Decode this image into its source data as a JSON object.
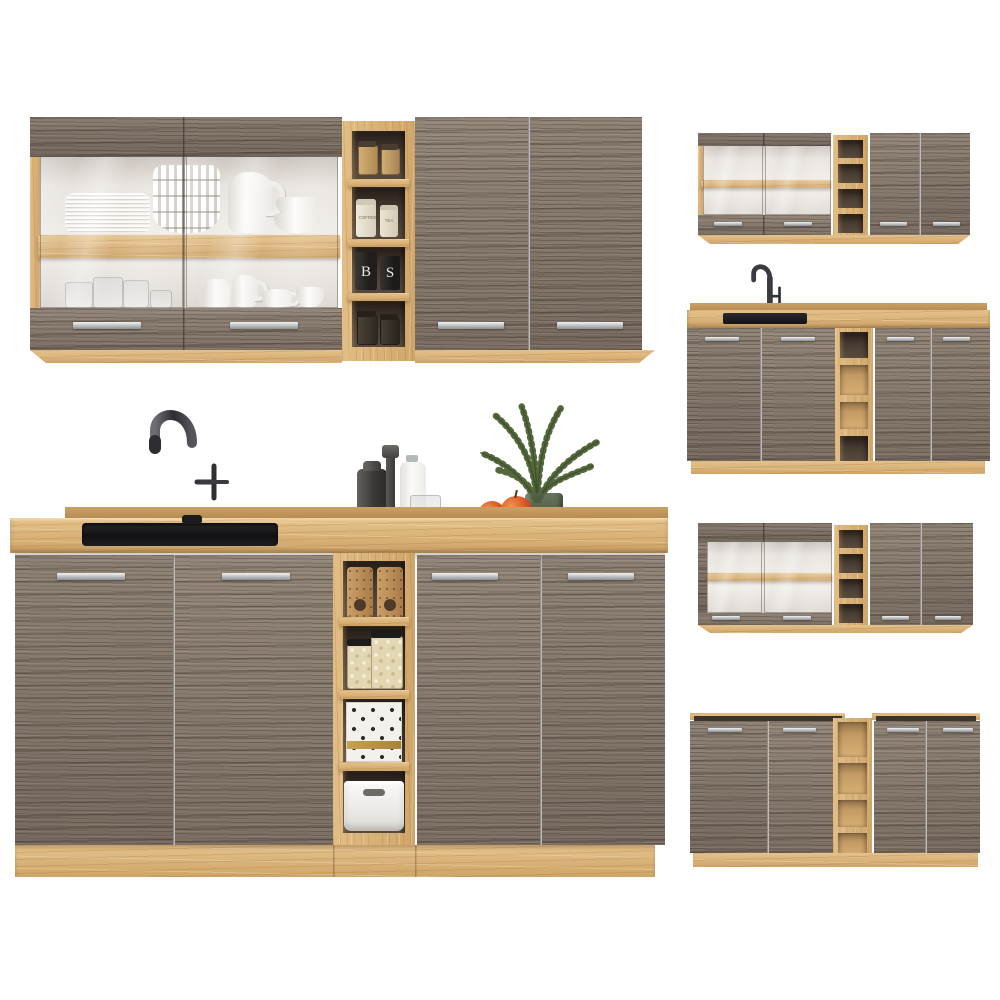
{
  "image": {
    "background": "#ffffff",
    "subject": "kitchen cabinet set, grey truffle woodgrain fronts with artisan oak frames"
  },
  "palette": {
    "oak": "#d9b075",
    "oak_light": "#e5c28b",
    "oak_dark": "#c49a62",
    "grey_wood": "#87796e",
    "grey_wood_dark": "#6f6358",
    "handle_silver": "#c4c7c9",
    "sink_black": "#1b1b1d",
    "faucet_metal": "#3a3a40",
    "interior_white": "#f2eee9",
    "plant_green": "#4f6236",
    "apple_red": "#d84f22",
    "vase_green": "#546547",
    "dish_white": "#fbfaf8"
  },
  "labels": {
    "coffee_canister": "COFFEE",
    "tea_canister": "TEA",
    "canister_b": "B",
    "canister_s": "S"
  }
}
